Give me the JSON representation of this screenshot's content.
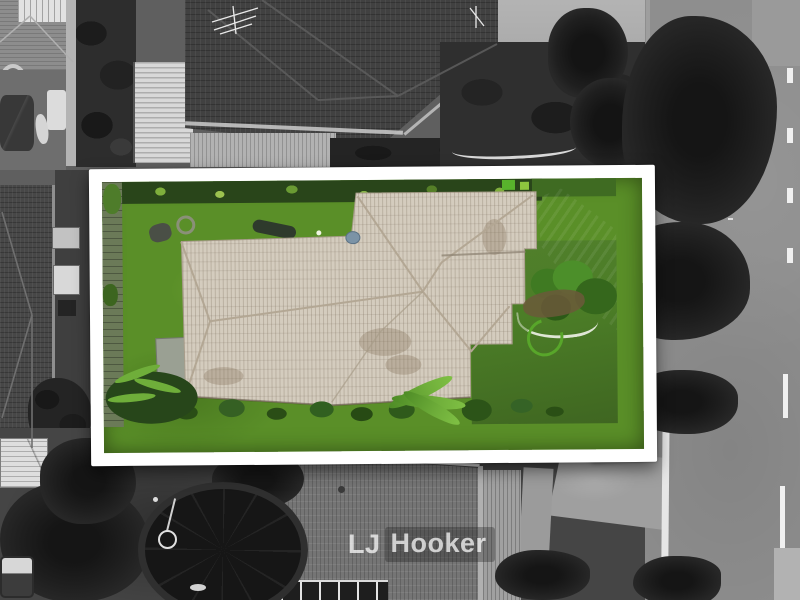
{
  "watermark": {
    "parts": [
      "LJ",
      "Hooker"
    ]
  },
  "scene": {
    "type": "aerial-property-photo",
    "highlight": "subject property in color inside white frame",
    "surroundings": "grayscale street, neighbours, trees"
  },
  "colors": {
    "frame_white": "#ffffff",
    "lawn_green": "#63a52e",
    "front_lawn_green": "#4c7e27",
    "roof_beige": "#d4ccbe",
    "roof_line": "#b3a794",
    "shrub_green": "#3f7a22",
    "palm_green": "#6fae3a",
    "hose_green": "#58a62a",
    "dish_blue": "#7b93a6",
    "driveway_gray": "#9a9c92",
    "road_gray": "#8e8e8e",
    "kerb_white": "#e6e6e6",
    "marking_white": "#f0f0f0",
    "foliage_dark": "#1c1c1c",
    "dark_roof_gray": "#414141",
    "bottom_roof_gray": "#757575"
  }
}
